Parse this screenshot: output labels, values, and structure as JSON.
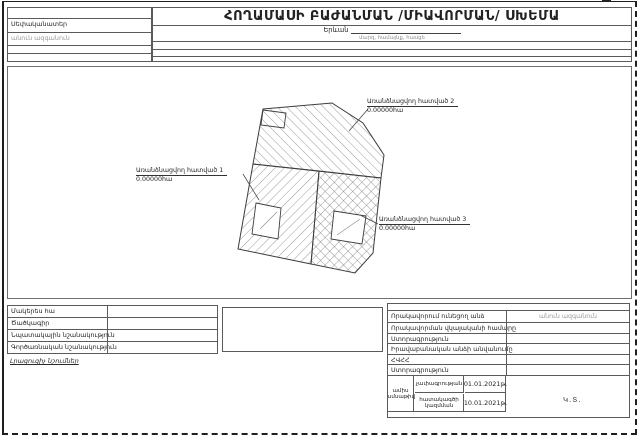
{
  "form": {
    "title": "ՀՈՂԱՄԱՍԻ ԲԱԺԱՆՄԱՆ /ՄԻԱՎՈՐՄԱՆ/ ՍԽԵՄԱ",
    "location": "Երևան",
    "location_caption": "մարզ, համայնք, հասցե"
  },
  "owner_block": {
    "owner_label": "Սեփականատեր",
    "owner_placeholder": "անուն ազգանուն"
  },
  "drawing": {
    "parcels": [
      {
        "name": "Առանձնացվող հատված 1",
        "area": "0.00000հա"
      },
      {
        "name": "Առանձնացվող հատված 2",
        "area": "0.00000հա"
      },
      {
        "name": "Առանձնացվող հատված 3",
        "area": "0.00000հա"
      }
    ]
  },
  "attributes_table": {
    "rows": [
      "Մակերես հա",
      "Ծածկագիր",
      "Նպատակային նշանակություն",
      "Գործառնական նշանակություն"
    ],
    "notes_label": "Լրացուցիչ նշումներ"
  },
  "certification_table": {
    "rows": [
      "Որակավորում ունեցող անձ",
      "Որակավորման վկայականի համարը",
      "Ստորագրություն",
      "Իրավաբանական անձի անվանումը",
      "ՀՎՀՀ",
      "Ստորագրություն"
    ],
    "person_placeholder": "անուն ազգանուն",
    "dates": {
      "header_line1": "ամիս",
      "header_line2": "ամսաթիվ",
      "rows": [
        {
          "label": "չափագրության",
          "date": "01.01.2021թ."
        },
        {
          "label": "հատակագծի կազմման",
          "date": "10.01.2021թ."
        }
      ]
    },
    "seal_mark": "Կ.Տ."
  },
  "colors": {
    "line": "#5a5a5a",
    "hatch": "#6f6f6f",
    "placeholder": "#9a9a9a"
  }
}
